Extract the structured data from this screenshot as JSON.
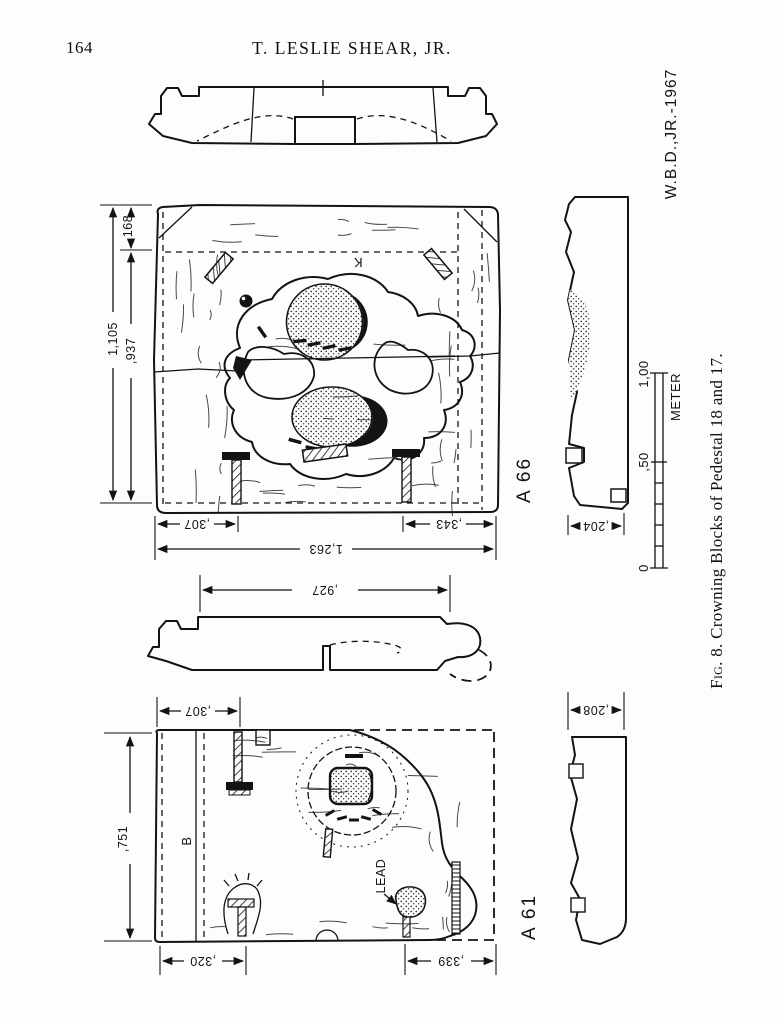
{
  "page": {
    "number": "164",
    "header": "T. LESLIE SHEAR, JR."
  },
  "figure": {
    "credit": "W.B.D.,JR.-1967",
    "caption_prefix": "Fig. 8.",
    "caption_text": " Crowning Blocks of Pedestal 18 and 17.",
    "scale": {
      "max": "1,00",
      "mid": ",50",
      "zero": "0",
      "unit": "METER"
    },
    "a66": {
      "label": "A 66",
      "point": "K",
      "d_168": ",168",
      "d_1105": "1,105",
      "d_937": ",937",
      "d_307": ",307",
      "d_1263": "1,263",
      "d_343": ",343",
      "d_204": ",204"
    },
    "mid_section": {
      "d_927": ",927"
    },
    "a61": {
      "label": "A 61",
      "strip": "B",
      "lead": "LEAD",
      "d_307": ",307",
      "d_751": ",751",
      "d_320": ",320",
      "d_339": ",339",
      "d_208": ",208"
    }
  }
}
